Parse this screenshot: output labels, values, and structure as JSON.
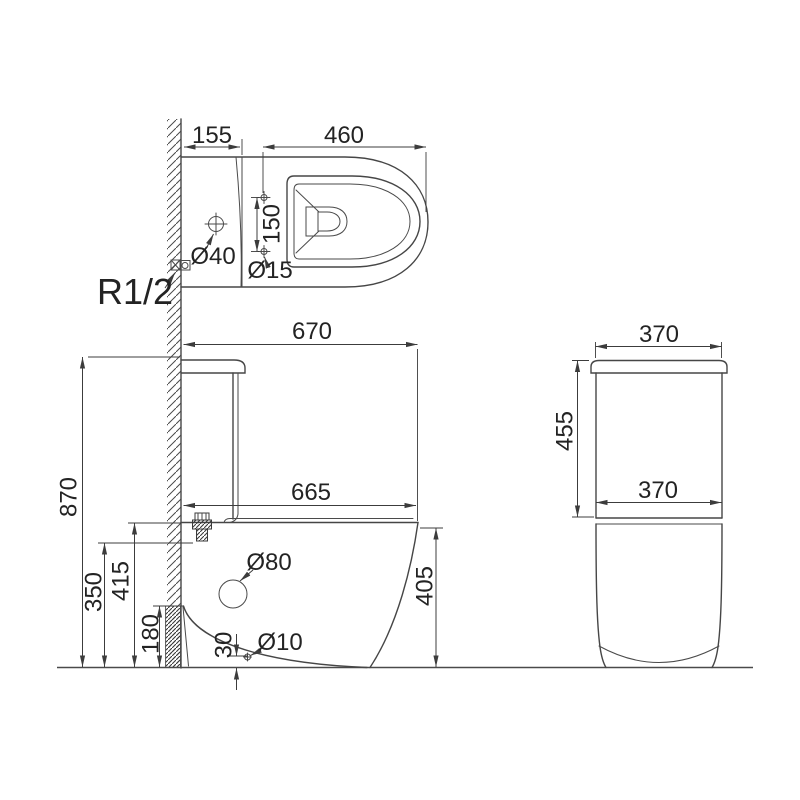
{
  "views": {
    "top": {
      "dims": {
        "cistern_depth": "155",
        "bowl_length": "460",
        "fixing_hole_spacing": "150",
        "lid_hole_dia": "Ø40",
        "fixing_hole_dia": "Ø15",
        "water_inlet": "R1/2"
      }
    },
    "side": {
      "dims": {
        "total_depth": "670",
        "total_height": "870",
        "rim_depth": "665",
        "rim_height": "415",
        "inlet_height": "350",
        "outlet_zone_height": "180",
        "front_height": "405",
        "outlet_dia": "Ø80",
        "small_hole_dia": "Ø10",
        "small_hole_height": "30"
      }
    },
    "rear": {
      "dims": {
        "top_width": "370",
        "cistern_height": "455",
        "bottom_width": "370"
      }
    }
  }
}
